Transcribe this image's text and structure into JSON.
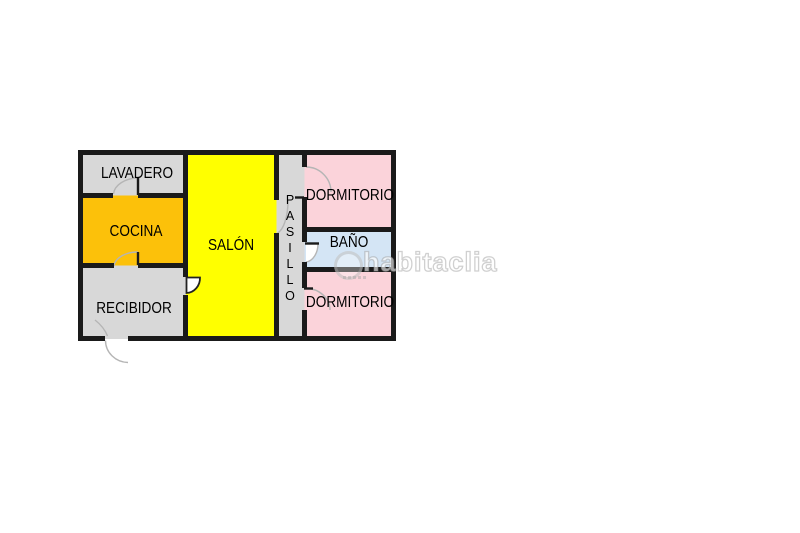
{
  "page": {
    "background": "#ffffff"
  },
  "floorplan": {
    "wall_color": "#1a1a1a",
    "arc_color": "#b5b5b5",
    "rooms": [
      {
        "id": "lavadero",
        "label": "LAVADERO",
        "color": "#d8d8d8"
      },
      {
        "id": "cocina",
        "label": "COCINA",
        "color": "#fcc10a"
      },
      {
        "id": "recibidor",
        "label": "RECIBIDOR",
        "color": "#d8d8d8"
      },
      {
        "id": "salon",
        "label": "SALÓN",
        "color": "#ffff00"
      },
      {
        "id": "pasillo",
        "label": "PASILLO",
        "color": "#d8d8d8"
      },
      {
        "id": "dormitorio-1",
        "label": "DORMITORIO",
        "color": "#fbd3da"
      },
      {
        "id": "bano",
        "label": "BAÑO",
        "color": "#d4e5f5"
      },
      {
        "id": "dormitorio-2",
        "label": "DORMITORIO",
        "color": "#fbd3da"
      }
    ]
  },
  "watermark": {
    "text": "habitaclia"
  }
}
